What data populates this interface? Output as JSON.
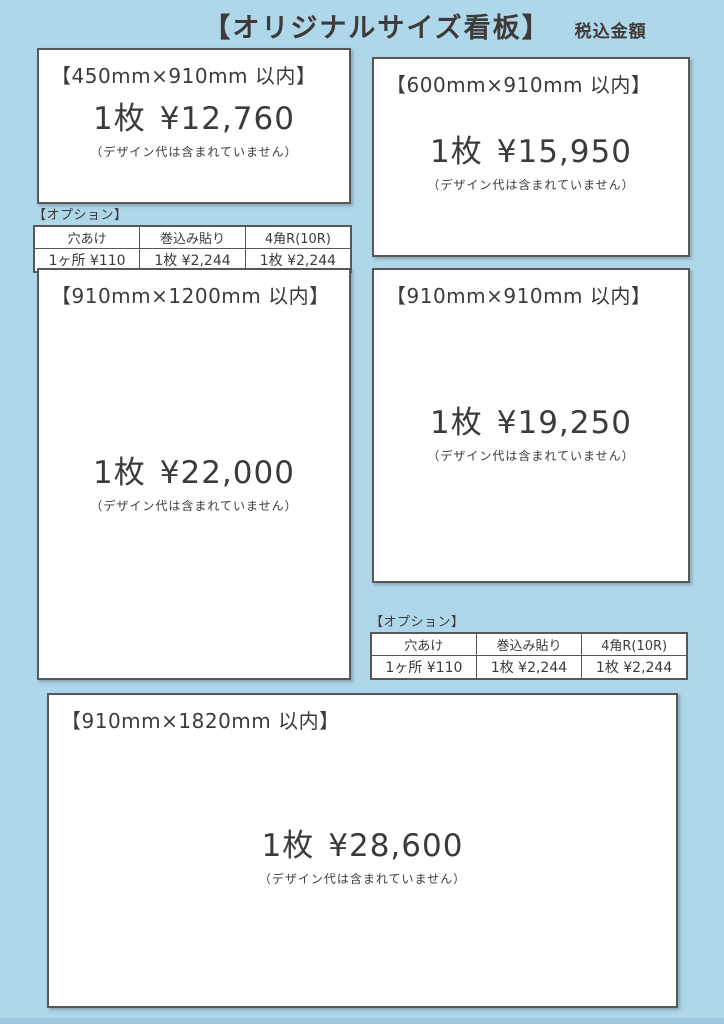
{
  "page": {
    "title": "【オリジナルサイズ看板】",
    "tax_note": "税込金額",
    "colors": {
      "background": "#AED7EA",
      "panel": "#FFFFFF",
      "border": "#595757",
      "text": "#3E3A39",
      "bottom_edge": "#9EC7DD"
    }
  },
  "products": [
    {
      "size_label": "【450mm×910mm 以内】",
      "qty": "1枚",
      "price": "¥12,760",
      "note": "（デザイン代は含まれていません）"
    },
    {
      "size_label": "【600mm×910mm 以内】",
      "qty": "1枚",
      "price": "¥15,950",
      "note": "（デザイン代は含まれていません）"
    },
    {
      "size_label": "【910mm×1200mm 以内】",
      "qty": "1枚",
      "price": "¥22,000",
      "note": "（デザイン代は含まれていません）"
    },
    {
      "size_label": "【910mm×910mm 以内】",
      "qty": "1枚",
      "price": "¥19,250",
      "note": "（デザイン代は含まれていません）"
    },
    {
      "size_label": "【910mm×1820mm 以内】",
      "qty": "1枚",
      "price": "¥28,600",
      "note": "（デザイン代は含まれていません）"
    }
  ],
  "option_tables": [
    {
      "label": "【オプション】",
      "columns": [
        "穴あけ",
        "巻込み貼り",
        "4角R(10R)"
      ],
      "values": [
        "1ヶ所 ¥110",
        "1枚 ¥2,244",
        "1枚 ¥2,244"
      ]
    },
    {
      "label": "【オプション】",
      "columns": [
        "穴あけ",
        "巻込み貼り",
        "4角R(10R)"
      ],
      "values": [
        "1ヶ所 ¥110",
        "1枚 ¥2,244",
        "1枚 ¥2,244"
      ]
    }
  ]
}
